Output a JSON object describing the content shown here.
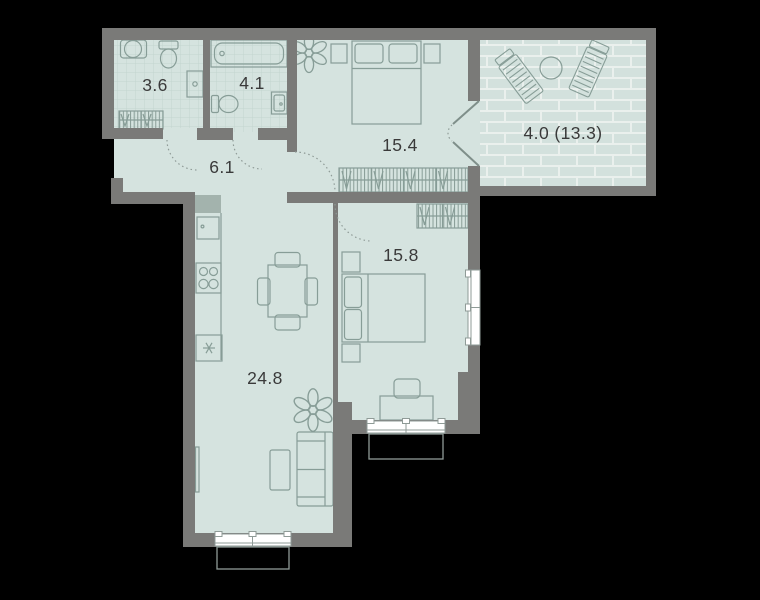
{
  "floorplan": {
    "type": "apartment-floor-plan",
    "rooms": [
      {
        "name": "bathroom-small",
        "area_label": "3.6"
      },
      {
        "name": "bathroom-large",
        "area_label": "4.1"
      },
      {
        "name": "hallway",
        "area_label": "6.1"
      },
      {
        "name": "bedroom-top",
        "area_label": "15.4"
      },
      {
        "name": "bedroom-right",
        "area_label": "15.8"
      },
      {
        "name": "living-kitchen",
        "area_label": "24.8"
      },
      {
        "name": "terrace",
        "area_label": "4.0 (13.3)"
      }
    ],
    "icons": [
      "double-bed-icon",
      "wardrobe-icon",
      "plant-icon",
      "bathtub-icon",
      "toilet-icon",
      "washing-machine-icon",
      "vanity-sink-icon",
      "kitchen-sink-icon",
      "stove-icon",
      "freezer-asterisk-icon",
      "dining-table-icon",
      "chair-icon",
      "sofa-icon",
      "coffee-table-icon",
      "desk-icon",
      "lounge-chair-icon",
      "terrace-table-icon",
      "window-icon",
      "door-swing-icon",
      "radiator-icon"
    ],
    "colors": {
      "background": "#000000",
      "wall": "#7a7a78",
      "floor": "#d5e3df",
      "tile_line": "#c2d4cf",
      "furniture_line": "#879d97",
      "brick_fill": "#d3e1dd",
      "brick_joint": "#eaf0ed",
      "window_fill": "#ffffff",
      "shaft_fill": "#a3b3ad",
      "label_color": "#3a3a3a"
    }
  }
}
